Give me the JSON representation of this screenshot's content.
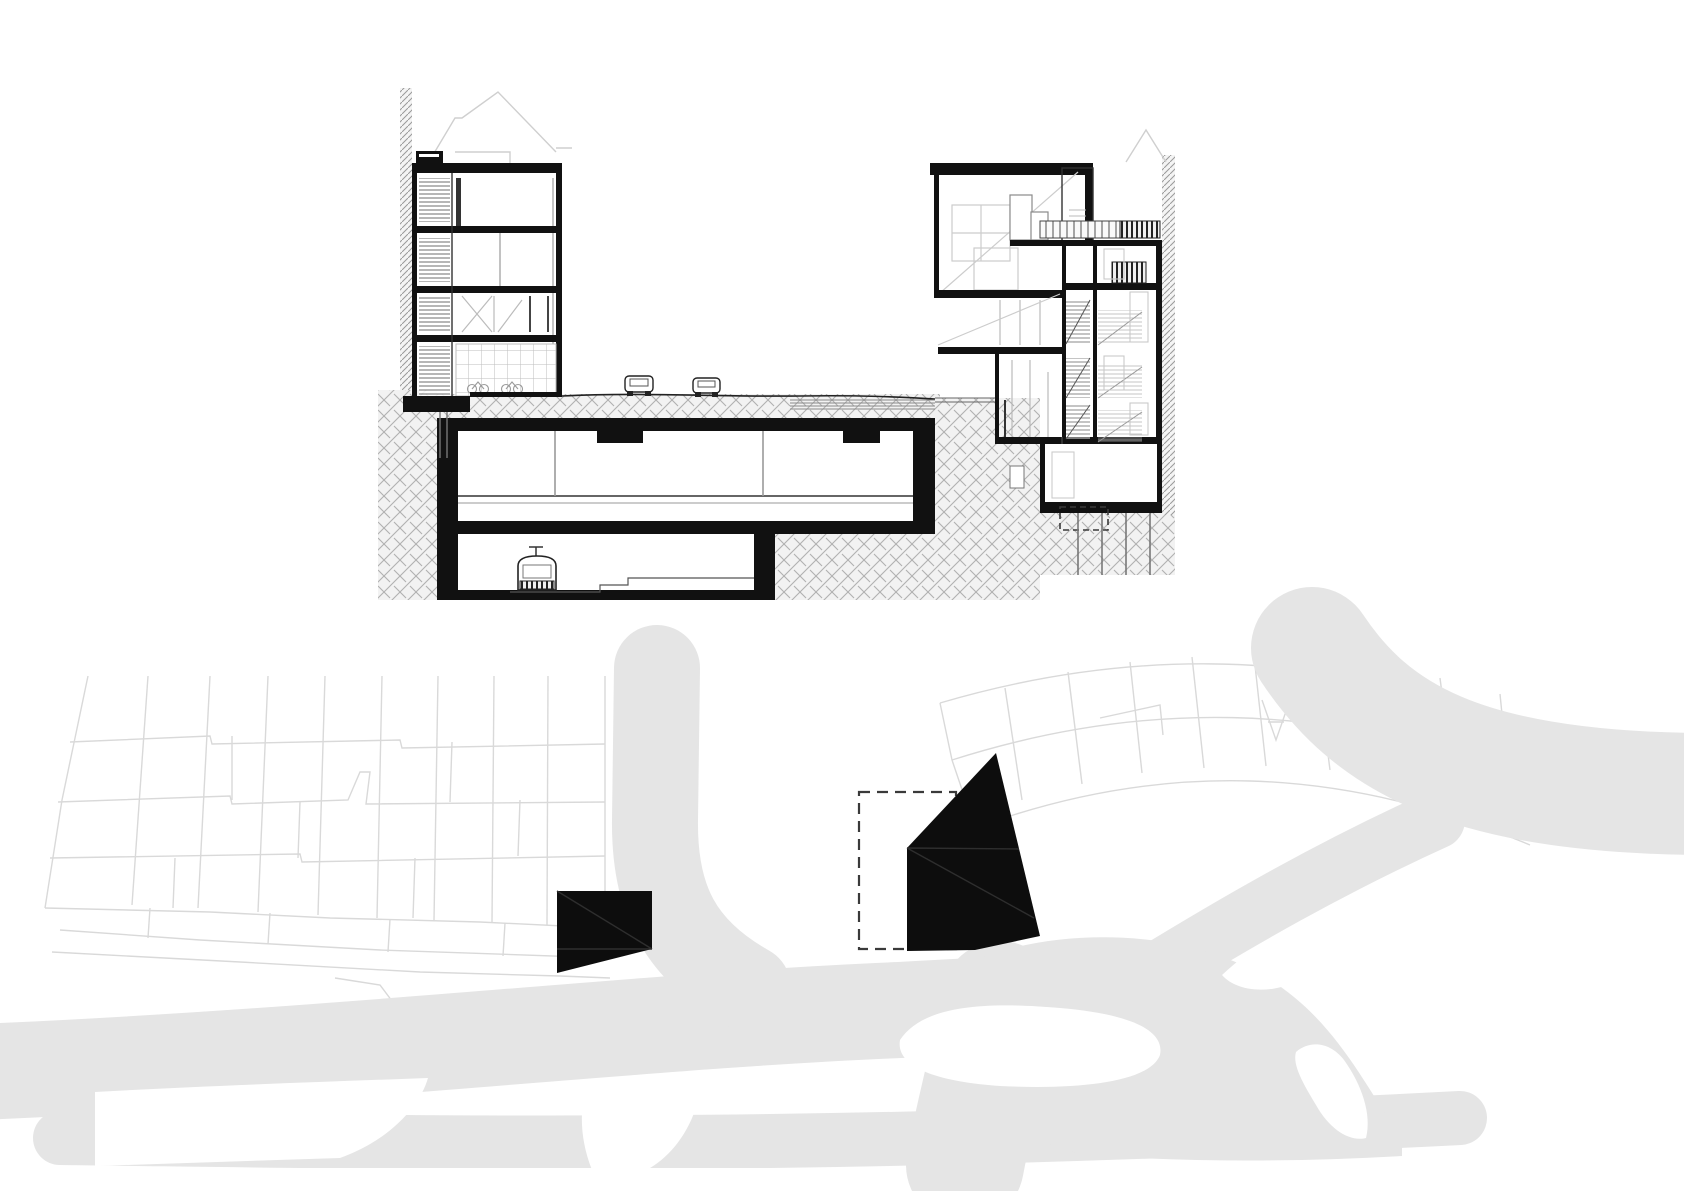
{
  "page": {
    "title": "Architectural drawing sheet",
    "views": [
      "building cross section",
      "site plan"
    ],
    "background": "#ffffff"
  },
  "colors": {
    "ink": "#111111",
    "black_fill": "#0d0d0d",
    "mid_line": "#555555",
    "faint_line": "#c9c9c9",
    "hatch_line": "#b0b0b0",
    "hatch_bg": "#f2f2f2",
    "road_fill": "#e5e5e5",
    "parcel_line": "#d9d9d9",
    "white": "#ffffff",
    "dashed_outline": "#3a3a3a"
  },
  "section_view": {
    "name": "Cross section through street, metro station and buildings",
    "left_building": {
      "name": "left building",
      "visible_floors": 4,
      "roof_outline": "pitched roof drawn in light gray behind flat roof",
      "ground_floor_finish": "tiled wall with bicycle parking",
      "stair_core_side": "left"
    },
    "right_building": {
      "name": "right building",
      "visible_floors": 6,
      "top_space": "double-height hall with diagonal brace",
      "roof_terrace_railing": true,
      "basement": true,
      "pile_foundations": true
    },
    "street": {
      "cars_visible": 2
    },
    "underground": {
      "station_levels": 2,
      "upper_level": "concourse box with two columns",
      "lower_level": "metro tunnel",
      "train_visible": 1,
      "ground_texture": "woven diagonal hatch"
    }
  },
  "site_plan": {
    "name": "site plan with ground figure of roads",
    "black_footprints": 2,
    "footprint_left": "small quadrilateral block",
    "footprint_center": "faceted wedge block",
    "dashed_rectangle": true,
    "parcel_fabric": [
      "left orthogonal block grid",
      "right fanned block grid"
    ],
    "roads": [
      "north-south street",
      "curved boulevard",
      "diagonal swath to top right",
      "multi-branch interchange"
    ]
  }
}
